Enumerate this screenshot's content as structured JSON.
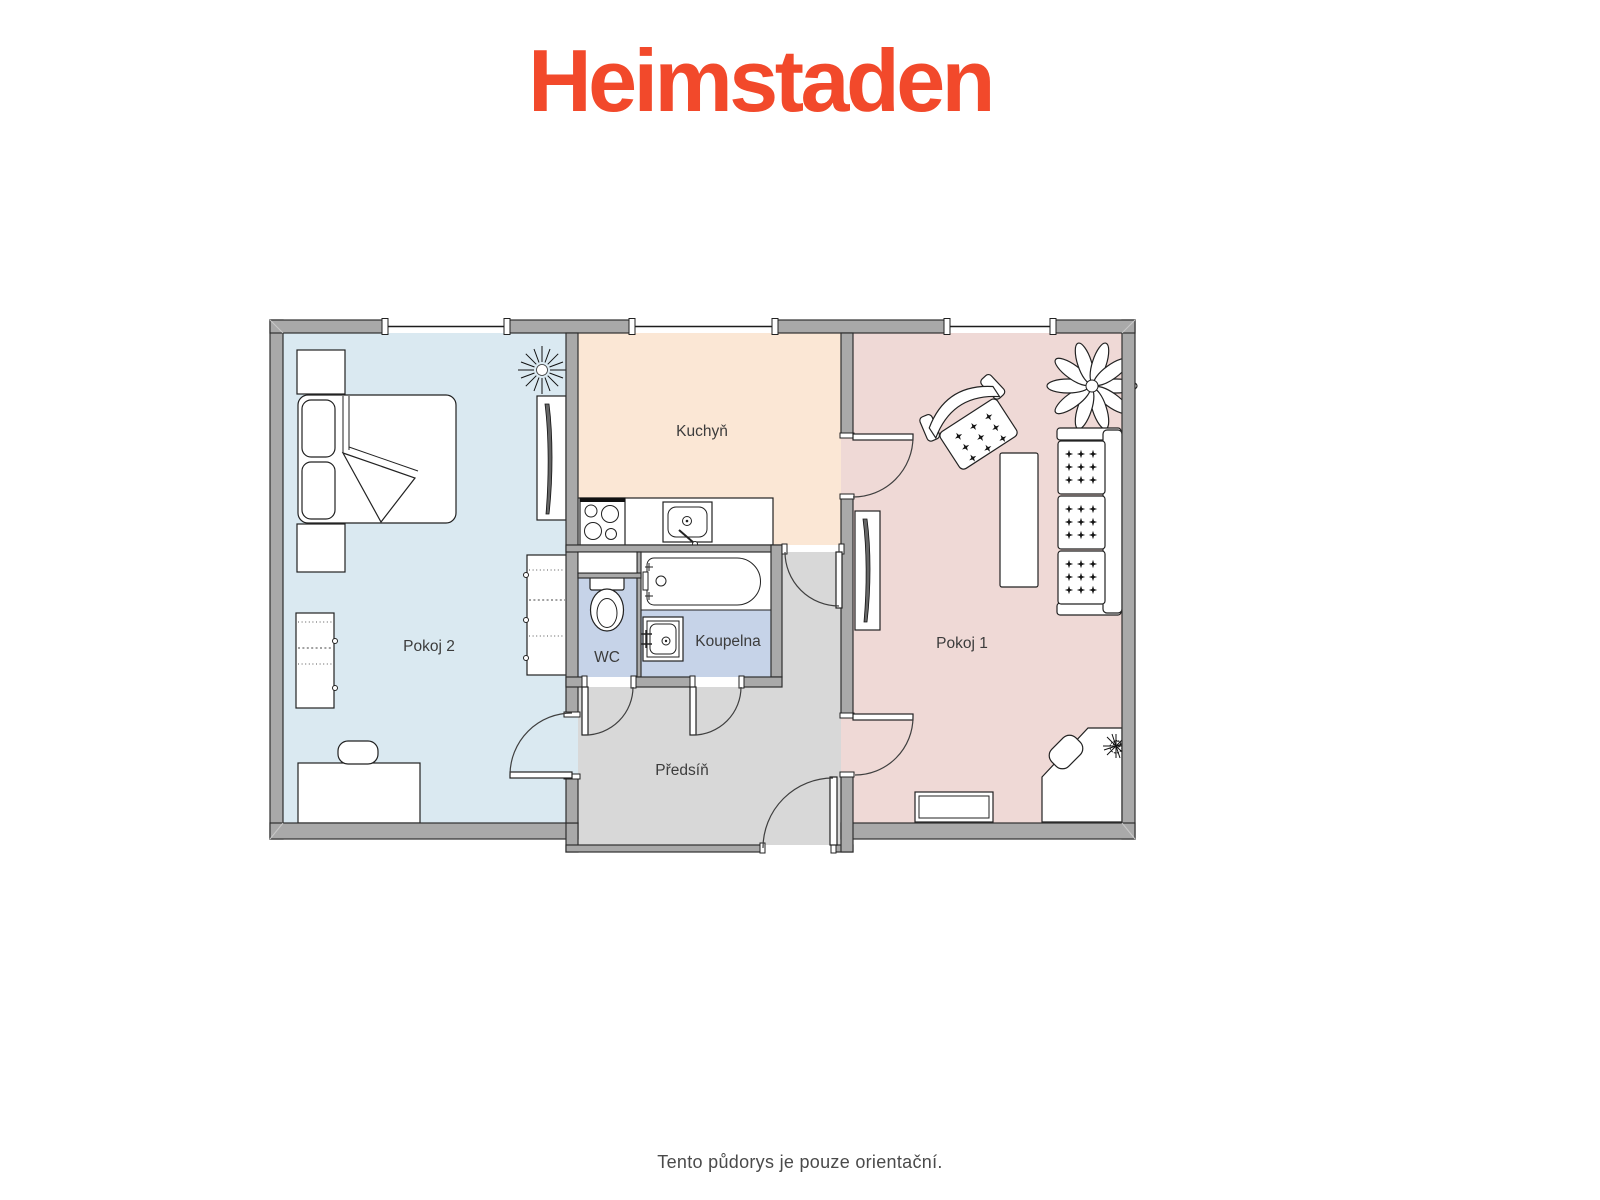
{
  "brand": {
    "logo_text": "Heimstaden",
    "logo_color": "#F2492B"
  },
  "floorplan": {
    "wall_color": "#A9A9A9",
    "rooms": [
      {
        "id": "pokoj2",
        "label": "Pokoj 2",
        "color": "#DAE9F1"
      },
      {
        "id": "kuchyn",
        "label": "Kuchyň",
        "color": "#FBE7D5"
      },
      {
        "id": "pokoj1",
        "label": "Pokoj 1",
        "color": "#EFD9D6"
      },
      {
        "id": "wc",
        "label": "WC",
        "color": "#C6D3E8"
      },
      {
        "id": "koupelna",
        "label": "Koupelna",
        "color": "#C6D3E8"
      },
      {
        "id": "predsin",
        "label": "Předsíň",
        "color": "#D8D8D8"
      }
    ],
    "furniture_icons": {
      "pokoj2": [
        "double-bed",
        "nightstand",
        "nightstand",
        "wardrobe",
        "wardrobe",
        "tv-panel",
        "desk",
        "chair",
        "sun-plant"
      ],
      "kuchyn": [
        "stove",
        "kitchen-sink",
        "counter"
      ],
      "koupelna": [
        "bathtub",
        "wash-basin"
      ],
      "wc": [
        "toilet"
      ],
      "pokoj1": [
        "armchair",
        "coffee-table",
        "sofa",
        "flower-plant",
        "tv-panel",
        "corner-desk",
        "desk-chair",
        "desk-plant",
        "low-cabinet"
      ]
    }
  },
  "footer": {
    "disclaimer": "Tento půdorys je pouze orientační."
  }
}
